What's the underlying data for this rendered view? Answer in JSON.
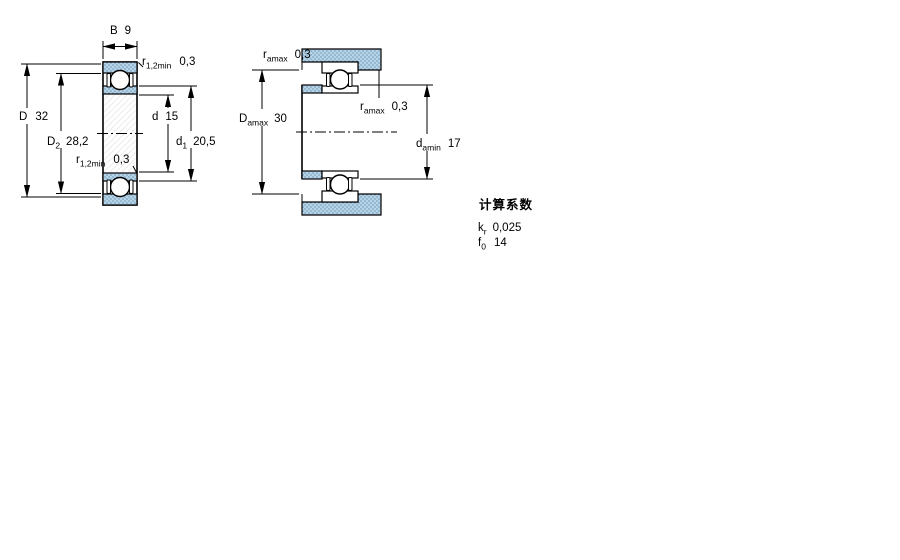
{
  "drawing": {
    "kind": "bearing-dimension-diagram",
    "background": "#ffffff",
    "colors": {
      "line": "#000000",
      "section_fill": "#b9d3e5",
      "section_dot": "#7aa6c8",
      "hatch": "#ececec"
    }
  },
  "left_view": {
    "name": "bearing cross-section with boundary dimensions",
    "labels": {
      "width": {
        "m": "B",
        "v": "9"
      },
      "r_top": {
        "m": "r",
        "s": "1,2min",
        "v": "0,3"
      },
      "outer_dia": {
        "m": "D",
        "v": "32"
      },
      "recess_dia": {
        "m": "D",
        "s": "2",
        "v": "28,2"
      },
      "bore_dia": {
        "m": "d",
        "v": "15"
      },
      "shoulder_dia": {
        "m": "d",
        "s": "1",
        "v": "20,5"
      },
      "r_bottom": {
        "m": "r",
        "s": "1,2min",
        "v": "0,3"
      }
    }
  },
  "right_view": {
    "name": "mounted bearing with abutment dimensions",
    "labels": {
      "ra_top": {
        "m": "r",
        "s": "amax",
        "v": "0,3"
      },
      "housing_dia": {
        "m": "D",
        "s": "amax",
        "v": "30"
      },
      "ra_mid": {
        "m": "r",
        "s": "amax",
        "v": "0,3"
      },
      "shaft_dia": {
        "m": "d",
        "s": "amin",
        "v": "17"
      }
    }
  },
  "calculation_factors": {
    "title": "计算系数",
    "kr": {
      "m": "k",
      "s": "r",
      "v": "0,025"
    },
    "f0": {
      "m": "f",
      "s": "0",
      "v": "14"
    }
  }
}
